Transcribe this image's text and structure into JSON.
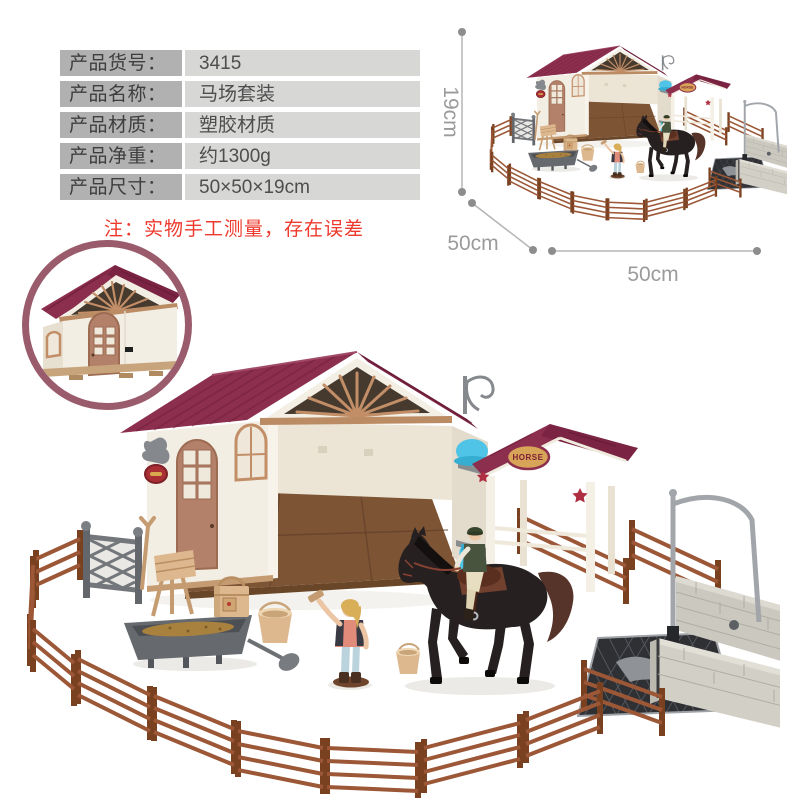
{
  "spec_table": {
    "rows": [
      {
        "label": "产品货号：",
        "value": "3415"
      },
      {
        "label": "产品名称：",
        "value": "马场套装"
      },
      {
        "label": "产品材质：",
        "value": "塑胶材质"
      },
      {
        "label": "产品净重：",
        "value": "约1300g"
      },
      {
        "label": "产品尺寸：",
        "value": "50×50×19cm"
      }
    ]
  },
  "note": {
    "text": "注：实物手工测量，存在误差"
  },
  "dimension_labels": {
    "height": "19cm",
    "depth": "50cm",
    "width": "50cm"
  },
  "scene": {
    "porch_sign_text": "HORSE"
  },
  "colors": {
    "labelBg": "#b1b1b1",
    "valueBg": "#d7d7d6",
    "noteRed": "#ee392c",
    "dimText": "#9b9b9b",
    "dimLine": "#b5b5b5",
    "dimDot": "#8d8d8d",
    "ring": "#9a5c6d",
    "roof": "#8c2e4d",
    "roofDark": "#7a2342",
    "fan": "#c28e67",
    "wall": "#f2eee3",
    "wallShade": "#e7dfd0",
    "gableDark": "#46392e",
    "door": "#b3806a",
    "floor": "#7d5434",
    "fence": "#9c5737",
    "fenceDark": "#7a4121",
    "gate": "#73767a",
    "tan": "#ddb88f",
    "tanDark": "#c59c72",
    "trough": "#66696d",
    "feed": "#a8813f",
    "horse": "#262020",
    "horseBrown": "#56342a",
    "blue": "#4fc4e6",
    "blueDark": "#36aed2",
    "brick": "#cbc8bf",
    "brickLine": "#b0ada4",
    "pipe": "#a2a6aa",
    "star": "#ae2f42",
    "sign": "#d8a458",
    "signText": "#7c2036",
    "skin": "#ecc5a4",
    "hair": "#d8ae58",
    "girlShirt": "#e18b7b",
    "girlPants": "#bad3dc",
    "riderVest": "#49543f",
    "riderPants": "#e7ddc0",
    "grate": "#2f3034"
  }
}
